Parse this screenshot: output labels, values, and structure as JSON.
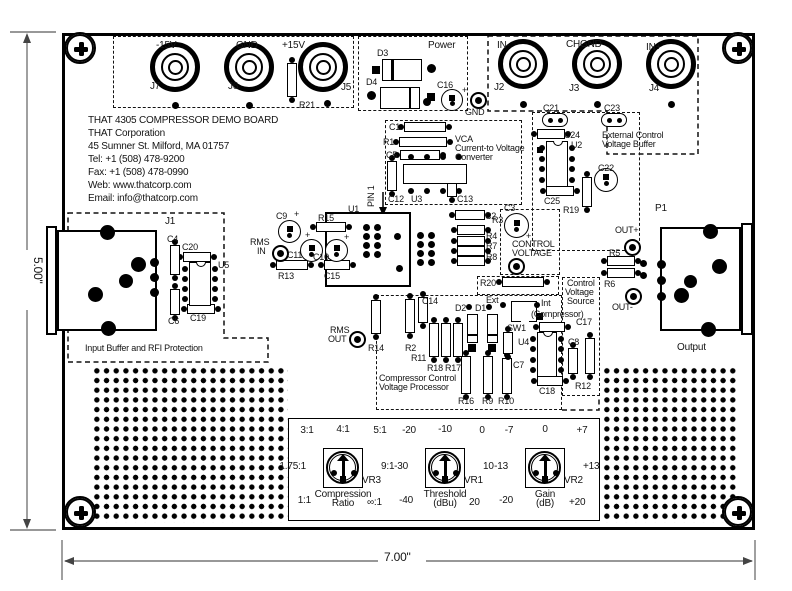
{
  "title_block": {
    "lines": [
      "THAT 4305 COMPRESSOR DEMO BOARD",
      "THAT Corporation",
      "45 Sumner St. Milford, MA 01757",
      "Tel: +1 (508) 478-9200",
      "Fax: +1 (508) 478-0990",
      "Web: www.thatcorp.com",
      "Email: info@thatcorp.com"
    ]
  },
  "dim": {
    "h": "5.00\"",
    "w": "7.00\""
  },
  "colors": {
    "ink": "#141414",
    "dim_line": "#777777",
    "bg": "#ffffff"
  },
  "labels": [
    {
      "n": "jack-label-minus15v",
      "t": "-15V",
      "x": 156,
      "y": 41,
      "s": 10
    },
    {
      "n": "jack-ref-j7",
      "t": "J7",
      "x": 150,
      "y": 82,
      "s": 10
    },
    {
      "n": "jack-label-gnd",
      "t": "GND",
      "x": 236,
      "y": 41,
      "s": 10
    },
    {
      "n": "jack-ref-j6",
      "t": "J6",
      "x": 228,
      "y": 82,
      "s": 10
    },
    {
      "n": "jack-label-plus15v",
      "t": "+15V",
      "x": 282,
      "y": 41,
      "s": 10
    },
    {
      "n": "jack-ref-j5",
      "t": "J5",
      "x": 341,
      "y": 83,
      "s": 10
    },
    {
      "n": "ref-r21",
      "t": "R21",
      "x": 299,
      "y": 101
    },
    {
      "n": "section-power",
      "t": "Power",
      "x": 428,
      "y": 41,
      "s": 10
    },
    {
      "n": "ref-d3",
      "t": "D3",
      "x": 377,
      "y": 49
    },
    {
      "n": "ref-d4",
      "t": "D4",
      "x": 366,
      "y": 78
    },
    {
      "n": "ref-c16",
      "t": "C16",
      "x": 437,
      "y": 81
    },
    {
      "n": "plus-c16",
      "t": "+",
      "x": 462,
      "y": 86
    },
    {
      "n": "pad-label-gnd",
      "t": "GND",
      "x": 465,
      "y": 108
    },
    {
      "n": "jack-label-in-minus",
      "t": "IN-",
      "x": 497,
      "y": 41,
      "s": 10
    },
    {
      "n": "jack-ref-j2",
      "t": "J2",
      "x": 494,
      "y": 83,
      "s": 10
    },
    {
      "n": "jack-label-chgnd",
      "t": "CHGND",
      "x": 566,
      "y": 40,
      "s": 10
    },
    {
      "n": "jack-ref-j3",
      "t": "J3",
      "x": 569,
      "y": 84,
      "s": 10
    },
    {
      "n": "jack-label-in-plus",
      "t": "IN+",
      "x": 646,
      "y": 43,
      "s": 10
    },
    {
      "n": "jack-ref-j4",
      "t": "J4",
      "x": 649,
      "y": 84,
      "s": 10
    },
    {
      "n": "ref-c1",
      "t": "C1",
      "x": 389,
      "y": 123
    },
    {
      "n": "ref-r1",
      "t": "R1",
      "x": 383,
      "y": 138
    },
    {
      "n": "ref-c5",
      "t": "C5",
      "x": 386,
      "y": 151
    },
    {
      "n": "section-vca-1",
      "t": "VCA",
      "x": 455,
      "y": 135
    },
    {
      "n": "section-vca-2",
      "t": "Current-to Voltage",
      "x": 455,
      "y": 144
    },
    {
      "n": "section-vca-3",
      "t": "Converter",
      "x": 455,
      "y": 153
    },
    {
      "n": "ref-c12",
      "t": "C12",
      "x": 388,
      "y": 195
    },
    {
      "n": "ref-u3",
      "t": "U3",
      "x": 411,
      "y": 195
    },
    {
      "n": "ref-c13",
      "t": "C13",
      "x": 457,
      "y": 195
    },
    {
      "n": "ref-u1",
      "t": "U1",
      "x": 348,
      "y": 205
    },
    {
      "n": "note-pin1",
      "t": "PIN 1",
      "x": 367,
      "y": 207,
      "r": -90
    },
    {
      "n": "ref-c9",
      "t": "C9",
      "x": 276,
      "y": 212
    },
    {
      "n": "plus-c9",
      "t": "+",
      "x": 294,
      "y": 210
    },
    {
      "n": "ref-r15",
      "t": "R15",
      "x": 318,
      "y": 214
    },
    {
      "n": "pad-label-rms-in-1",
      "t": "RMS",
      "x": 250,
      "y": 238
    },
    {
      "n": "pad-label-rms-in-2",
      "t": "IN",
      "x": 257,
      "y": 247
    },
    {
      "n": "ref-c11",
      "t": "C11",
      "x": 287,
      "y": 251
    },
    {
      "n": "plus-c11",
      "t": "+",
      "x": 305,
      "y": 231
    },
    {
      "n": "ref-c10",
      "t": "C10",
      "x": 313,
      "y": 253
    },
    {
      "n": "plus-c10",
      "t": "+",
      "x": 344,
      "y": 233
    },
    {
      "n": "ref-r13",
      "t": "R13",
      "x": 278,
      "y": 272
    },
    {
      "n": "ref-c15",
      "t": "C15",
      "x": 324,
      "y": 272
    },
    {
      "n": "pad-label-rms-out-1",
      "t": "RMS",
      "x": 330,
      "y": 326
    },
    {
      "n": "pad-label-rms-out-2",
      "t": "OUT",
      "x": 328,
      "y": 335
    },
    {
      "n": "ref-r14",
      "t": "R14",
      "x": 368,
      "y": 344
    },
    {
      "n": "ref-c2",
      "t": "C2",
      "x": 485,
      "y": 212
    },
    {
      "n": "ref-r3",
      "t": "R3",
      "x": 492,
      "y": 216
    },
    {
      "n": "ref-r4",
      "t": "R4",
      "x": 486,
      "y": 232
    },
    {
      "n": "ref-r7",
      "t": "R7",
      "x": 486,
      "y": 242
    },
    {
      "n": "ref-r8",
      "t": "R8",
      "x": 486,
      "y": 253
    },
    {
      "n": "ref-c3",
      "t": "C3",
      "x": 504,
      "y": 204
    },
    {
      "n": "plus-c3",
      "t": "+",
      "x": 526,
      "y": 232
    },
    {
      "n": "section-control-voltage-1",
      "t": "CONTROL",
      "x": 512,
      "y": 240
    },
    {
      "n": "section-control-voltage-2",
      "t": "VOLTAGE",
      "x": 512,
      "y": 249
    },
    {
      "n": "ref-r20",
      "t": "R20",
      "x": 480,
      "y": 279
    },
    {
      "n": "ref-c21",
      "t": "C21",
      "x": 543,
      "y": 104
    },
    {
      "n": "ref-c23",
      "t": "C23",
      "x": 604,
      "y": 104
    },
    {
      "n": "ref-c24",
      "t": "C24",
      "x": 564,
      "y": 131
    },
    {
      "n": "ref-u2",
      "t": "U2",
      "x": 571,
      "y": 141
    },
    {
      "n": "section-ext-buffer-1",
      "t": "External Control",
      "x": 602,
      "y": 131
    },
    {
      "n": "section-ext-buffer-2",
      "t": "Voltage Buffer",
      "x": 602,
      "y": 140
    },
    {
      "n": "ref-c22",
      "t": "C22",
      "x": 598,
      "y": 164
    },
    {
      "n": "ref-c25",
      "t": "C25",
      "x": 544,
      "y": 197
    },
    {
      "n": "ref-r19",
      "t": "R19",
      "x": 563,
      "y": 206
    },
    {
      "n": "ref-p1",
      "t": "P1",
      "x": 655,
      "y": 204,
      "s": 10
    },
    {
      "n": "ref-j1",
      "t": "J1",
      "x": 165,
      "y": 217,
      "s": 10
    },
    {
      "n": "ref-c4",
      "t": "C4",
      "x": 167,
      "y": 235
    },
    {
      "n": "ref-c20",
      "t": "C20",
      "x": 182,
      "y": 243
    },
    {
      "n": "ref-u5",
      "t": "U5",
      "x": 218,
      "y": 261
    },
    {
      "n": "ref-c6",
      "t": "C6",
      "x": 168,
      "y": 317
    },
    {
      "n": "ref-c19",
      "t": "C19",
      "x": 190,
      "y": 314
    },
    {
      "n": "section-input-buffer",
      "t": "Input Buffer and RFI Protection",
      "x": 85,
      "y": 344
    },
    {
      "n": "pad-label-out-plus",
      "t": "OUT+",
      "x": 615,
      "y": 226
    },
    {
      "n": "ref-r5",
      "t": "R5",
      "x": 609,
      "y": 249
    },
    {
      "n": "ref-r6",
      "t": "R6",
      "x": 604,
      "y": 280
    },
    {
      "n": "pad-label-out-minus",
      "t": "OUT-",
      "x": 612,
      "y": 303
    },
    {
      "n": "section-output",
      "t": "Output",
      "x": 677,
      "y": 343,
      "s": 10
    },
    {
      "n": "ref-c14",
      "t": "C14",
      "x": 422,
      "y": 297
    },
    {
      "n": "ref-r2",
      "t": "R2",
      "x": 405,
      "y": 344
    },
    {
      "n": "ref-r11",
      "t": "R11",
      "x": 411,
      "y": 354
    },
    {
      "n": "ref-r18",
      "t": "R18",
      "x": 427,
      "y": 364
    },
    {
      "n": "ref-r17",
      "t": "R17",
      "x": 445,
      "y": 364
    },
    {
      "n": "ref-d2",
      "t": "D2",
      "x": 455,
      "y": 304
    },
    {
      "n": "ref-d1",
      "t": "D1",
      "x": 475,
      "y": 304
    },
    {
      "n": "switch-label-ext",
      "t": "Ext",
      "x": 486,
      "y": 296
    },
    {
      "n": "ref-sw1",
      "t": "SW1",
      "x": 507,
      "y": 324
    },
    {
      "n": "switch-label-int",
      "t": "Int",
      "x": 541,
      "y": 299
    },
    {
      "n": "section-cvs-4",
      "t": "(Compressor)",
      "x": 531,
      "y": 310
    },
    {
      "n": "section-cvs-1",
      "t": "Control",
      "x": 567,
      "y": 279
    },
    {
      "n": "section-cvs-2",
      "t": "Voltage",
      "x": 565,
      "y": 288
    },
    {
      "n": "section-cvs-3",
      "t": "Source",
      "x": 567,
      "y": 297
    },
    {
      "n": "ref-c17",
      "t": "C17",
      "x": 576,
      "y": 318
    },
    {
      "n": "ref-u4",
      "t": "U4",
      "x": 518,
      "y": 338
    },
    {
      "n": "ref-c8",
      "t": "C8",
      "x": 568,
      "y": 338
    },
    {
      "n": "ref-c7",
      "t": "C7",
      "x": 513,
      "y": 361
    },
    {
      "n": "ref-r16",
      "t": "R16",
      "x": 458,
      "y": 397
    },
    {
      "n": "ref-r9",
      "t": "R9",
      "x": 482,
      "y": 397
    },
    {
      "n": "ref-r10",
      "t": "R10",
      "x": 498,
      "y": 397
    },
    {
      "n": "ref-c18",
      "t": "C18",
      "x": 539,
      "y": 387
    },
    {
      "n": "ref-r12",
      "t": "R12",
      "x": 575,
      "y": 382
    },
    {
      "n": "section-cvp-1",
      "t": "Compressor Control",
      "x": 379,
      "y": 374
    },
    {
      "n": "section-cvp-2",
      "t": "Voltage Processor",
      "x": 379,
      "y": 383
    }
  ],
  "controls": [
    {
      "name": "VR3",
      "label": "VR3",
      "caption": [
        "Compression",
        "Ratio"
      ],
      "ticks": {
        "tl": "3:1",
        "t": "4:1",
        "tr": "5:1",
        "l": "1.75:1",
        "r": "9:1",
        "bl": "1:1",
        "br": "∞:1"
      }
    },
    {
      "name": "VR1",
      "label": "VR1",
      "caption": [
        "Threshold",
        "(dBu)"
      ],
      "ticks": {
        "tl": "-20",
        "t": "-10",
        "tr": "0",
        "l": "-30",
        "r": "10",
        "bl": "-40",
        "br": "20"
      }
    },
    {
      "name": "VR2",
      "label": "VR2",
      "caption": [
        "Gain",
        "(dB)"
      ],
      "ticks": {
        "tl": "-7",
        "t": "0",
        "tr": "+7",
        "l": "-13",
        "r": "+13",
        "bl": "-20",
        "br": "+20"
      }
    }
  ]
}
